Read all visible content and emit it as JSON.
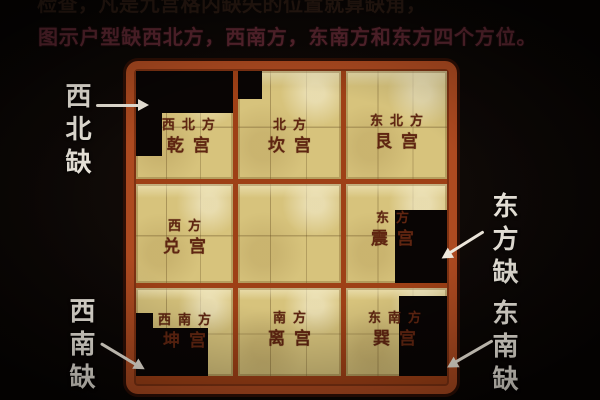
{
  "title_lines": {
    "line1": "检查，凡是九宫格内缺失的位置就算缺角，",
    "line2": "图示户型缺西北方，西南方，东南方和东方四个方位。"
  },
  "grid": {
    "cells": [
      {
        "direction": "西北方",
        "palace": "乾宫",
        "missing": true
      },
      {
        "direction": "北方",
        "palace": "坎宫",
        "missing": false
      },
      {
        "direction": "东北方",
        "palace": "艮宫",
        "missing": false
      },
      {
        "direction": "西方",
        "palace": "兑宫",
        "missing": false
      },
      {
        "direction": "",
        "palace": "",
        "missing": false
      },
      {
        "direction": "东方",
        "palace": "震宫",
        "missing": true
      },
      {
        "direction": "西南方",
        "palace": "坤宫",
        "missing": true
      },
      {
        "direction": "南方",
        "palace": "离宫",
        "missing": false
      },
      {
        "direction": "东南方",
        "palace": "巽宫",
        "missing": true
      }
    ]
  },
  "callouts": {
    "northwest": "西北缺",
    "east": "东方缺",
    "southwest": "西南缺",
    "southeast": "东南缺"
  },
  "colors": {
    "background": "#0d0806",
    "frame_border": "#ad4a20",
    "grid_lines": "#9e4016",
    "plan_paper": "#d7c37c",
    "palace_text": "#5f2511",
    "subtitle_text": "#5b2630",
    "title_text": "#2a1a12",
    "callout_text": "#f1ece2",
    "missing_area": "#090504"
  }
}
